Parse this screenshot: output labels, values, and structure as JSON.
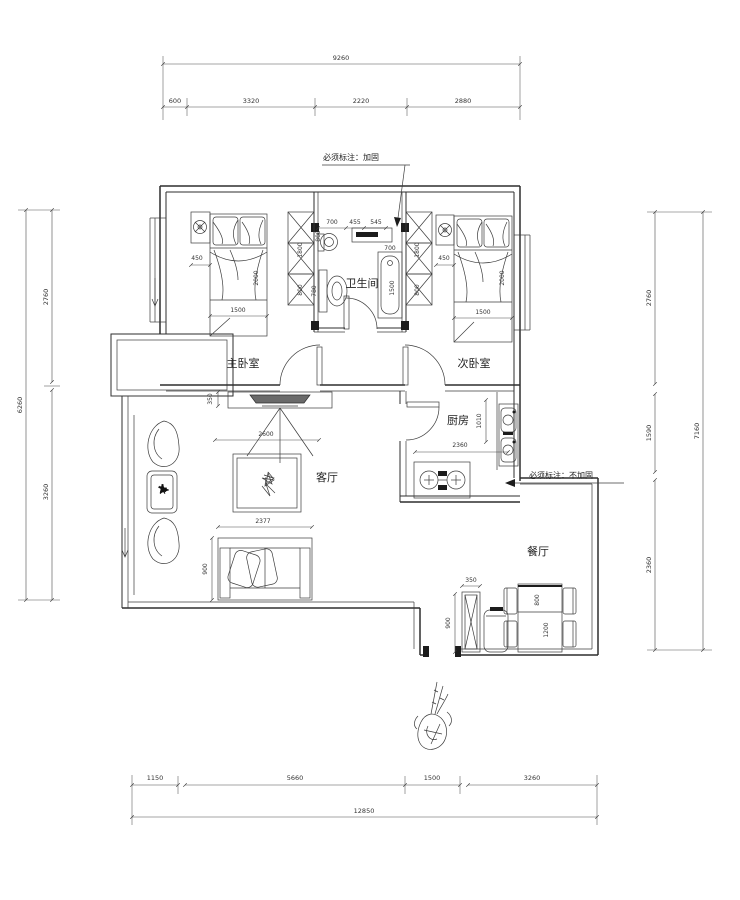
{
  "annotations": {
    "top_note": "必须标注：加固",
    "right_note": "必须标注：不加固"
  },
  "rooms": {
    "master_bedroom": "主卧室",
    "second_bedroom": "次卧室",
    "bathroom": "卫生间",
    "kitchen": "厨房",
    "living_room": "客厅",
    "dining_room": "餐厅"
  },
  "dim_top": {
    "total": "9260",
    "seg": [
      "600",
      "3320",
      "2220",
      "2880"
    ]
  },
  "dim_bottom": {
    "total": "12850",
    "seg": [
      "1150",
      "5660",
      "1500",
      "3260"
    ]
  },
  "dim_left": {
    "total": "6260",
    "seg": [
      "2760",
      "3260"
    ]
  },
  "dim_right": {
    "total": "7160",
    "seg": [
      "2760",
      "1590",
      "2360"
    ]
  },
  "dims": {
    "master": {
      "nightstand": "450",
      "bed_len": "2000",
      "bed_w": "1500",
      "ward_a": "1800",
      "ward_b": "800"
    },
    "second": {
      "nightstand": "450",
      "bed_len": "2000",
      "bed_w": "1500",
      "ward_a": "1800",
      "ward_b": "800"
    },
    "bath": {
      "a": "700",
      "b": "455",
      "c": "545",
      "basin": "800",
      "toilet": "780",
      "tub_w": "700",
      "tub_l": "1500"
    },
    "kitchen": {
      "w": "2360",
      "h": "1010"
    },
    "living": {
      "tv_depth": "350",
      "tv_wall": "2600",
      "table": "2377",
      "sofa": "900"
    },
    "dining": {
      "cab_w": "350",
      "cab_h": "900",
      "table_w": "800",
      "table_l": "1200"
    }
  },
  "colors": {
    "line": "#2e2e2e",
    "background": "#ffffff"
  }
}
